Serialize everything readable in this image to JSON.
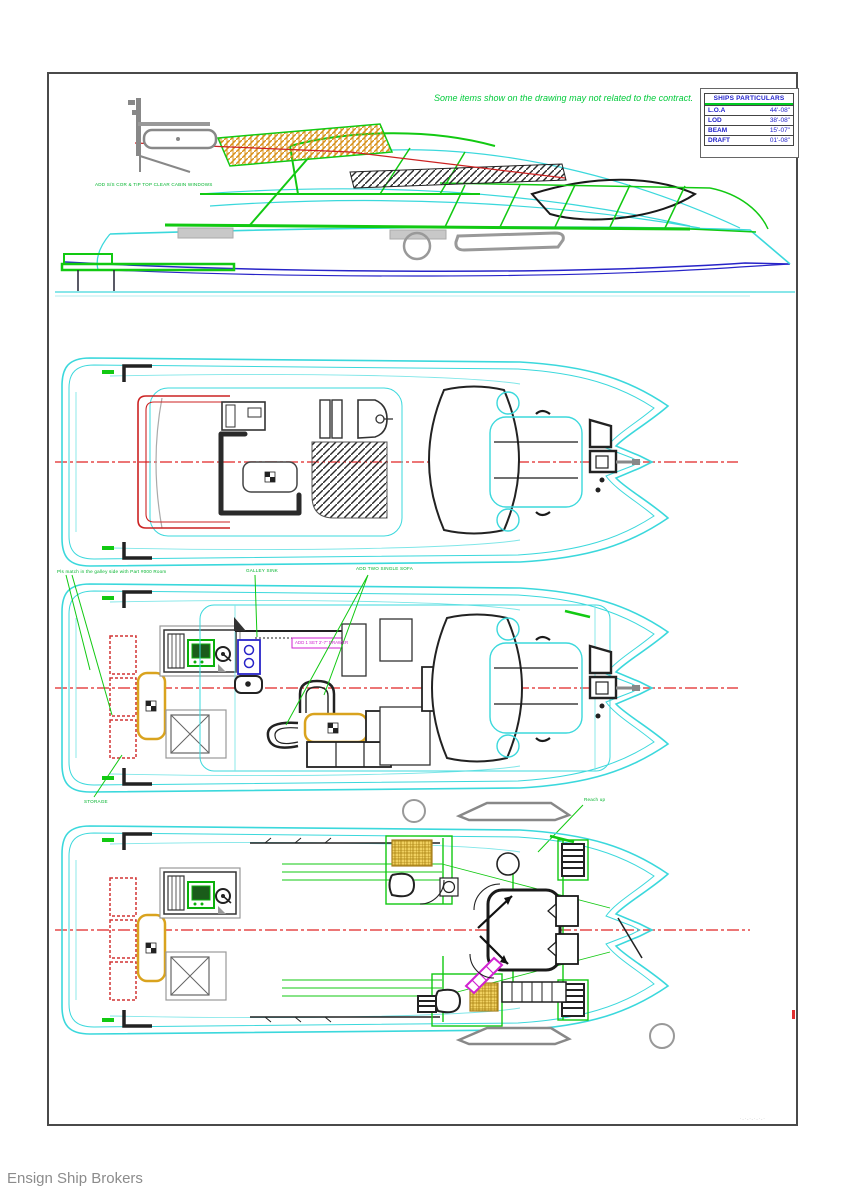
{
  "sheet": {
    "disclaimer": "Some items show on the drawing may not related to the contract.",
    "footer": "Ensign Ship Brokers",
    "corner_mark": "·‐·‐·‐·‐·‐·"
  },
  "particulars": {
    "title": "SHIPS PARTICULARS",
    "rows": [
      {
        "label": "L.O.A",
        "value": "44'-08\""
      },
      {
        "label": "LOD",
        "value": "38'-08\""
      },
      {
        "label": "BEAM",
        "value": "15'-07\""
      },
      {
        "label": "DRAFT",
        "value": "01'-08\""
      }
    ]
  },
  "annotations": {
    "profile_note": "ADD S/S COR & TIP TOP CLEAR CABIN WINDOWS",
    "main_deck_note_left": "Pls match in the galley side with Part #000 Room",
    "main_deck_note_mid": "GALLEY SINK",
    "main_deck_note_right": "ADD TWO SINGLE SOFA",
    "main_deck_note_stern": "STORAGE",
    "galley_counter_note": "ADD 1 SET 2'-7\" DRAWER",
    "lower_deck_note": "Reach up"
  },
  "colors": {
    "hull_outline_cyan": "#3bd8dc",
    "structure_green": "#12c912",
    "centerline_red": "#e64848",
    "chine_blue": "#2824c8",
    "table_orange": "#d9a31e",
    "stairs_magenta": "#d022d0",
    "annotation_green": "#00b32c",
    "particulars_blue": "#2222cc"
  }
}
